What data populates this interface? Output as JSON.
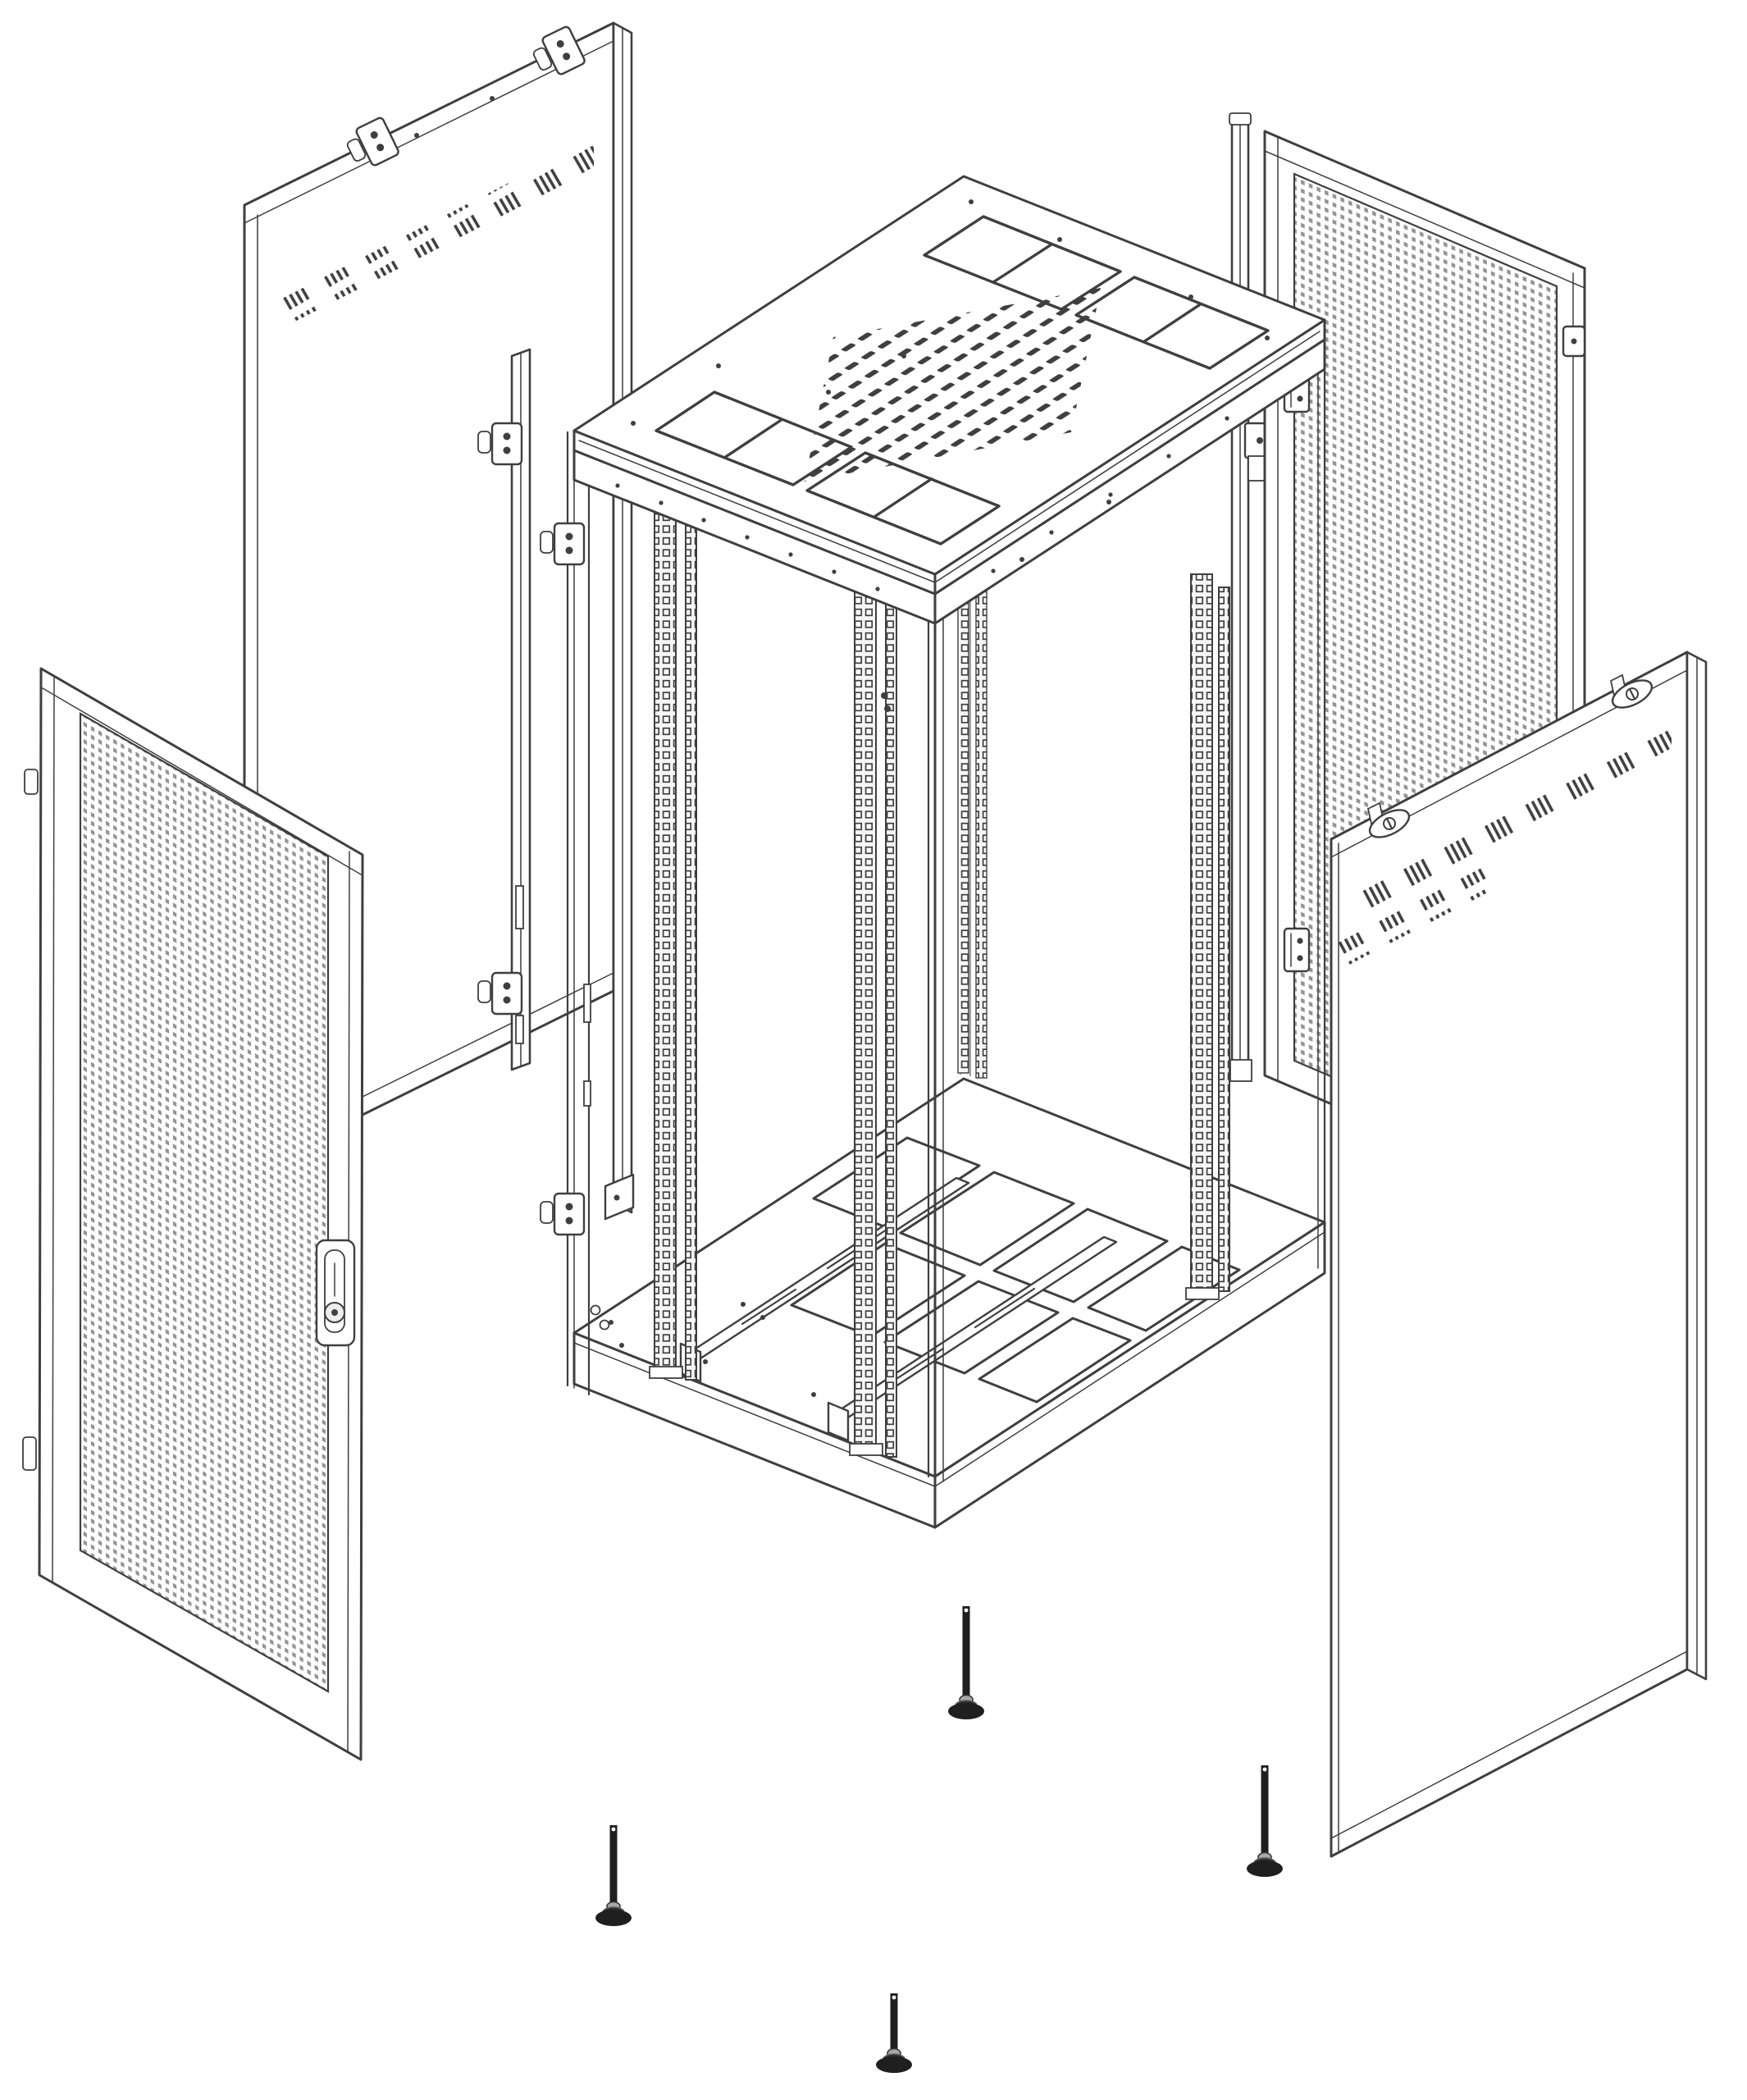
{
  "palette": {
    "background": "#ffffff",
    "line": "#3f3f3f",
    "line_soft": "#8a8a8a",
    "mesh_dot": "#949494",
    "metal": "#b9b9b9",
    "foot": "#1f1f1f"
  },
  "figure": {
    "kind": "exploded-assembly-line-drawing",
    "subject": "server rack cabinet exploded view",
    "parts": [
      {
        "id": "side-panel-left",
        "features": [
          "angled-vent-slashes",
          "top-latch-clamps",
          "edge-flange"
        ],
        "clamp_count": 2
      },
      {
        "id": "door-hinge-rail",
        "features": [
          "hinge-lugs"
        ],
        "hinge_count": 2
      },
      {
        "id": "front-mesh-door",
        "features": [
          "perforated-mesh",
          "swing-handle-with-lock",
          "hinge-pins"
        ],
        "hinge_pin_count": 2
      },
      {
        "id": "rack-frame",
        "features": [
          "vented-top-cover",
          "cable-entry-cutouts",
          "square-hole-mounting-rails",
          "base-knockout-panels",
          "slide-rails",
          "door-hinge-brackets"
        ],
        "cable_cutout_count": 4,
        "mounting_rail_pairs": 4
      },
      {
        "id": "rear-lock-rail",
        "features": [
          "lock-blocks"
        ]
      },
      {
        "id": "rear-mesh-door",
        "features": [
          "perforated-mesh",
          "hinges",
          "latch-pin"
        ],
        "hinge_count": 2
      },
      {
        "id": "side-panel-right",
        "features": [
          "angled-vent-slashes",
          "cam-locks",
          "top-tabs"
        ],
        "cam_lock_count": 2
      },
      {
        "id": "leveling-feet",
        "count": 4
      }
    ]
  }
}
